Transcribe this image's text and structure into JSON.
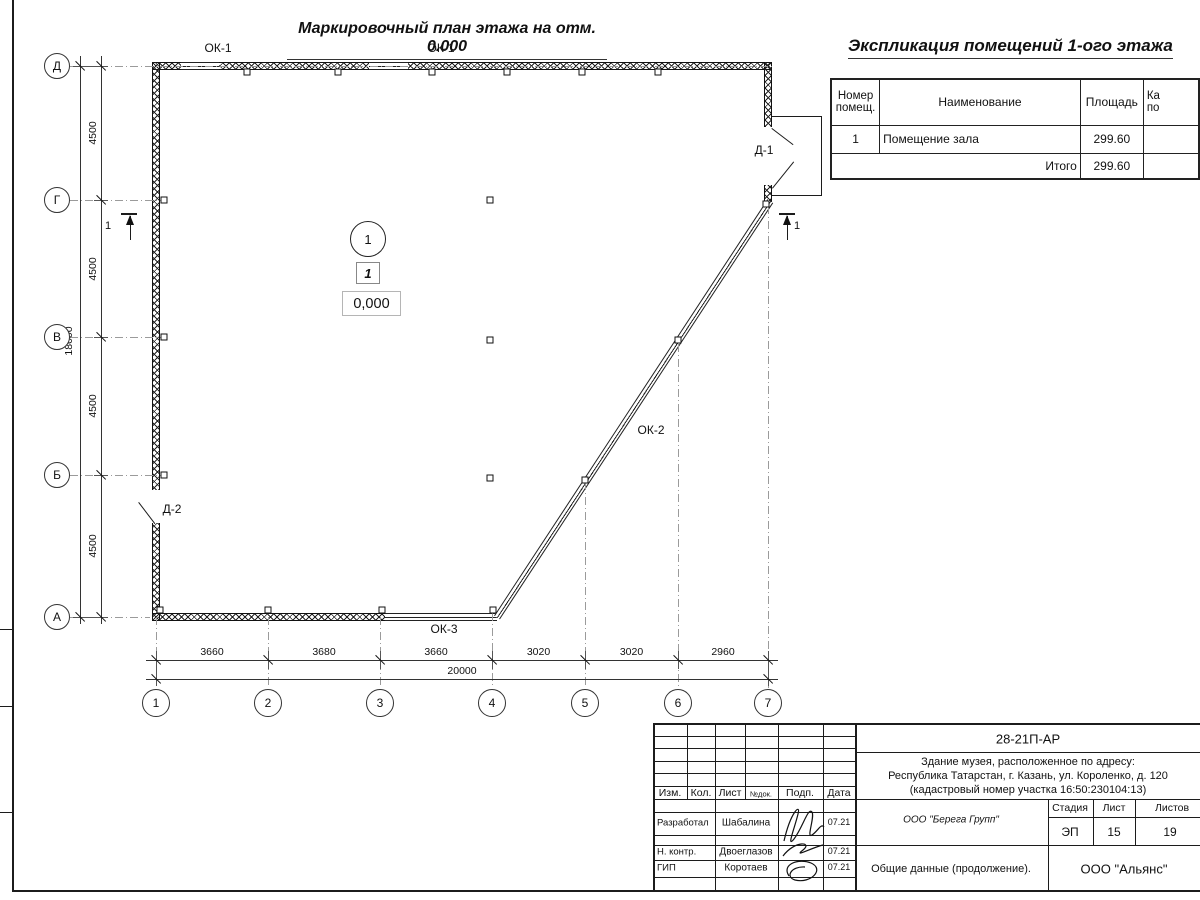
{
  "drawing": {
    "plan_title": "Маркировочный план этажа на отм. 0.000",
    "row_axes": [
      "Д",
      "Г",
      "В",
      "Б",
      "А"
    ],
    "col_axes": [
      "1",
      "2",
      "3",
      "4",
      "5",
      "6",
      "7"
    ],
    "dims_bottom": [
      "3660",
      "3680",
      "3660",
      "3020",
      "3020",
      "2960"
    ],
    "dim_bottom_total": "20000",
    "dims_left": [
      "4500",
      "4500",
      "4500",
      "4500"
    ],
    "dim_left_total": "18000",
    "labels": {
      "window_top_left": "ОК-1",
      "window_top_right": "ОК-1",
      "window_diagonal": "ОК-2",
      "window_bottom": "ОК-3",
      "door_right": "Д-1",
      "door_left": "Д-2",
      "room_number": "1",
      "zone_number": "1",
      "elevation": "0,000",
      "section_left": "1",
      "section_right": "1"
    }
  },
  "explication": {
    "title": "Экспликация помещений 1-ого этажа",
    "headers": {
      "num_line1": "Номер",
      "num_line2": "помещ.",
      "name": "Наименование",
      "area": "Площадь",
      "cat_line1": "Ка",
      "cat_line2": "по"
    },
    "rows": [
      {
        "num": "1",
        "name": "Помещение зала",
        "area": "299.60"
      }
    ],
    "total_label": "Итого",
    "total_area": "299.60"
  },
  "titleblock": {
    "doc_number": "28-21П-АР",
    "address_line1": "Здание музея, расположенное по адресу:",
    "address_line2": "Республика Татарстан, г. Казань, ул. Короленко, д. 120",
    "address_line3": "(кадастровый номер участка 16:50:230104:13)",
    "cols": [
      "Изм.",
      "Кол.",
      "Лист",
      "№док.",
      "Подп.",
      "Дата"
    ],
    "rows": [
      {
        "role": "Разработал",
        "name": "Шабалина",
        "date": "07.21"
      },
      {
        "role": "Н. контр.",
        "name": "Двоеглазов",
        "date": "07.21"
      },
      {
        "role": "ГИП",
        "name": "Коротаев",
        "date": "07.21"
      }
    ],
    "company": "ООО \"Берега Групп\"",
    "stage_label": "Стадия",
    "sheet_label": "Лист",
    "sheets_label": "Листов",
    "stage": "ЭП",
    "sheet": "15",
    "sheets": "19",
    "doc_title": "Общие данные (продолжение).",
    "org": "ООО \"Альянс\""
  }
}
